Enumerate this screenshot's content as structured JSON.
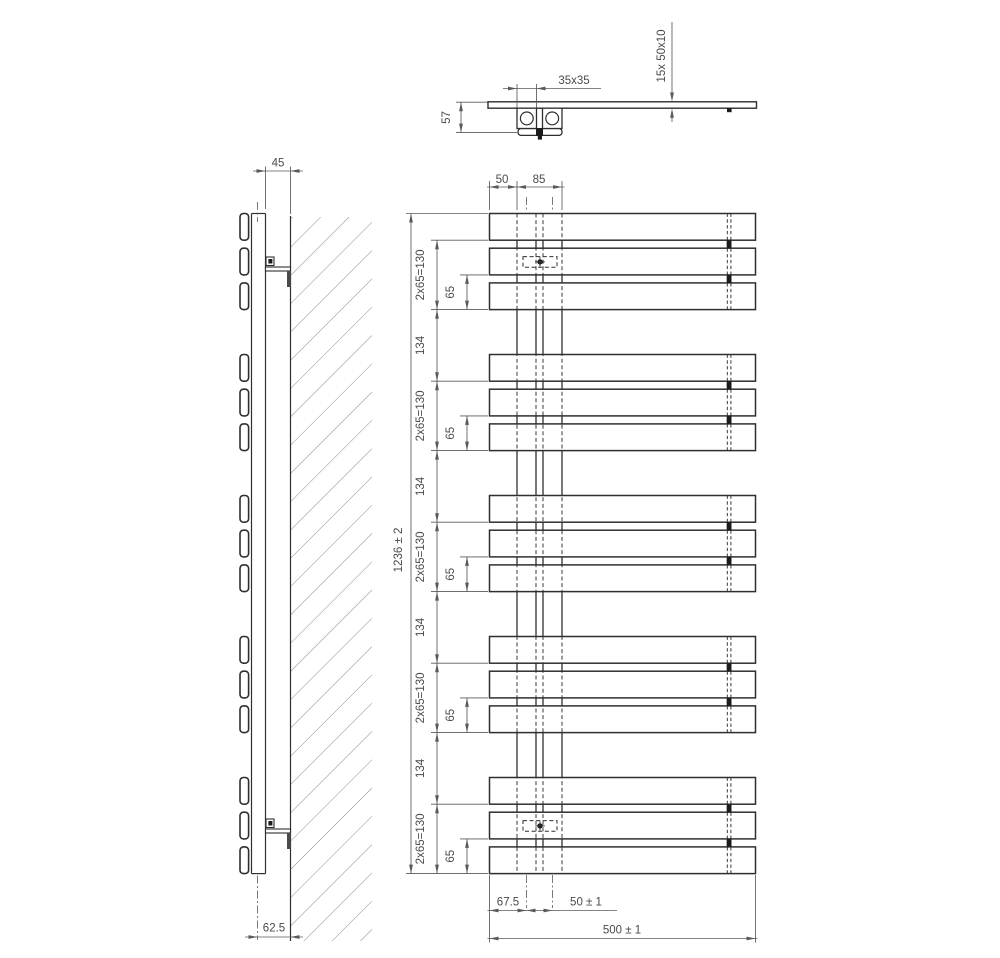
{
  "colors": {
    "background": "#ffffff",
    "object_line": "#2f2f2f",
    "dim_line": "#5a5a5a",
    "text": "#4a4a4a",
    "hatch": "#8c8c8c",
    "dark_fill": "#1c1c1c"
  },
  "top_view": {
    "dim_depth": "57",
    "dim_tube_profile": "35x35",
    "dim_slat_count_profile": "15x  50x10"
  },
  "side_view": {
    "dim_wall_clearance": "45",
    "dim_axis_to_wall": "62.5"
  },
  "front_view": {
    "dim_edge_to_tube": "50",
    "dim_tube_span": "85",
    "dim_total_height": "1236 ± 2",
    "dim_double_pitch": "2x65=130",
    "dim_slat_pitch": "65",
    "dim_group_gap": "134",
    "dim_conn_offset": "67.5",
    "dim_conn_spacing": "50 ± 1",
    "dim_total_width": "500 ± 1",
    "slat_count": 15,
    "group_count": 5,
    "slats_per_group": 3
  }
}
